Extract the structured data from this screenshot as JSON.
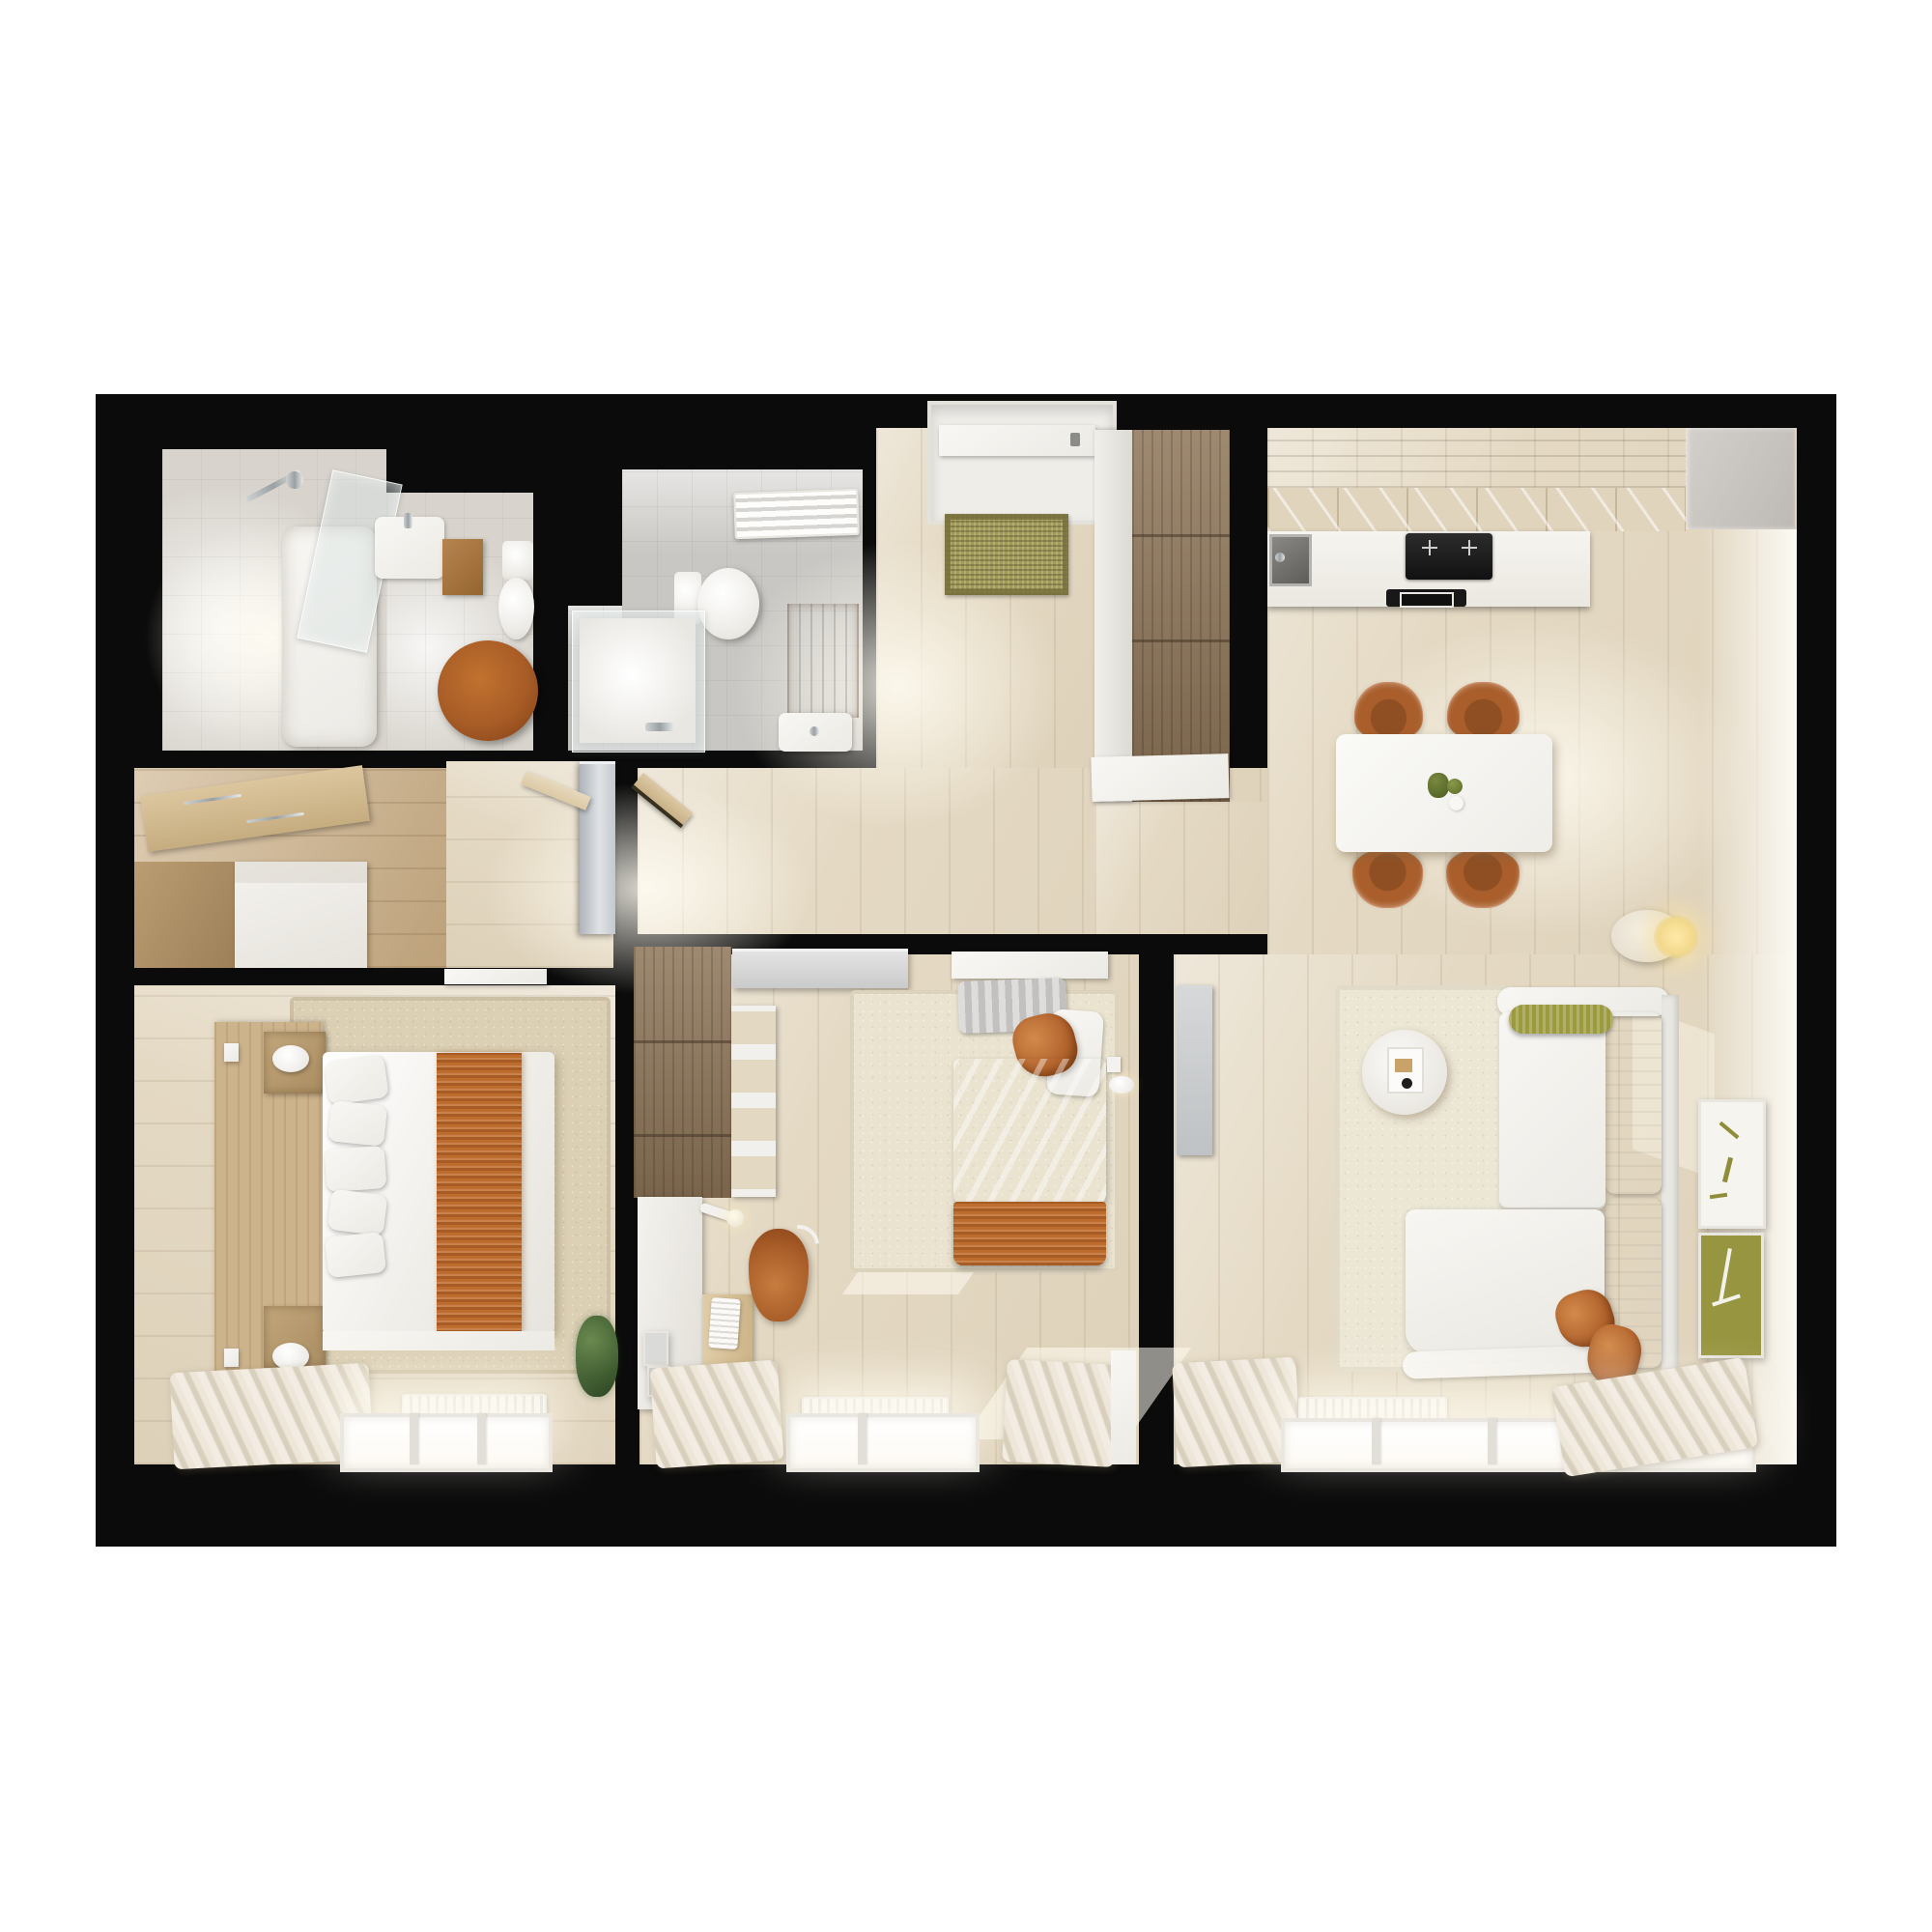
{
  "meta": {
    "view": "top-down 3d apartment floor plan render",
    "visible_text": "none"
  },
  "palette": {
    "wall-black": "#0b0b0b",
    "floor-wood": "#e4d9c3",
    "floor-bright": "#f2e9d8",
    "floor-oak": "#c8ab81",
    "bath1-floor": "#d8d4cd",
    "bath2-floor": "#c9c7c3",
    "walnut": "#8d7458",
    "headboard-oak": "#cdb38c",
    "white-furniture": "#f4f2ed",
    "counter-white": "#f2efe9",
    "kitchen-upper-wood": "#b3a084",
    "kitchen-cabinet-wood": "#e0d4bc",
    "steel-gray": "#8f8d89",
    "hob-black": "#151515",
    "fridge-gray": "#c9c5c0",
    "accent-orange": "#b2632d",
    "accent-orange-deep": "#8f4c1d",
    "knit-orange": "#bf6d2e",
    "olive-green": "#97953f",
    "khaki-mat": "#a29a58",
    "locker-gray": "#c3c8cd",
    "duvet-gray": "#cdccca",
    "rug-beige": "#dbcfb4",
    "rug-ivory": "#ece6d5",
    "radiator-white": "#efece7",
    "curtain-dark": "#d8cfbd",
    "wood-door": "#dcc9a5",
    "stool-wood": "#a85c26"
  },
  "rooms": [
    {
      "name": "bathroom-1",
      "furniture": [
        "shower-fixture",
        "shower-glass-panel",
        "bathtub",
        "sink",
        "wood-counter",
        "toilet",
        "round-wooden-stool"
      ]
    },
    {
      "name": "bathroom-2",
      "furniture": [
        "towel-radiator",
        "toilet",
        "shower-enclosure",
        "wood-bath-mat",
        "sink"
      ]
    },
    {
      "name": "entry-hall",
      "furniture": [
        "entry-door",
        "doormat",
        "tall-wardrobe"
      ]
    },
    {
      "name": "inner-hall",
      "furniture": [
        "gray-cabinet",
        "open-doors",
        "closet-wardrobe",
        "clothes-rail"
      ]
    },
    {
      "name": "kitchen-dining",
      "furniture": [
        "upper-cabinets",
        "countertop",
        "kitchen-sink",
        "induction-hob",
        "extractor-hood",
        "fridge",
        "dining-table",
        "dining-chairs",
        "fruit-set"
      ]
    },
    {
      "name": "living-room",
      "furniture": [
        "sofa",
        "chaise",
        "olive-bolster",
        "orange-pillows",
        "side-table",
        "area-rug",
        "floor-lamp",
        "wall-art",
        "gray-wall-panel",
        "radiator",
        "window",
        "curtains"
      ]
    },
    {
      "name": "bedroom-1",
      "furniture": [
        "double-bed",
        "pillows",
        "orange-runner",
        "headboard",
        "nightstands",
        "reading-lamps",
        "area-rug",
        "plant",
        "radiator",
        "window",
        "curtain"
      ]
    },
    {
      "name": "bedroom-2",
      "furniture": [
        "single-bed",
        "gray-duvet",
        "orange-blanket",
        "wardrobe",
        "open-shelves",
        "desk",
        "keyboard",
        "desk-lamp",
        "desk-chair",
        "wall-lamp",
        "area-rug",
        "radiator",
        "window",
        "curtains"
      ]
    }
  ]
}
